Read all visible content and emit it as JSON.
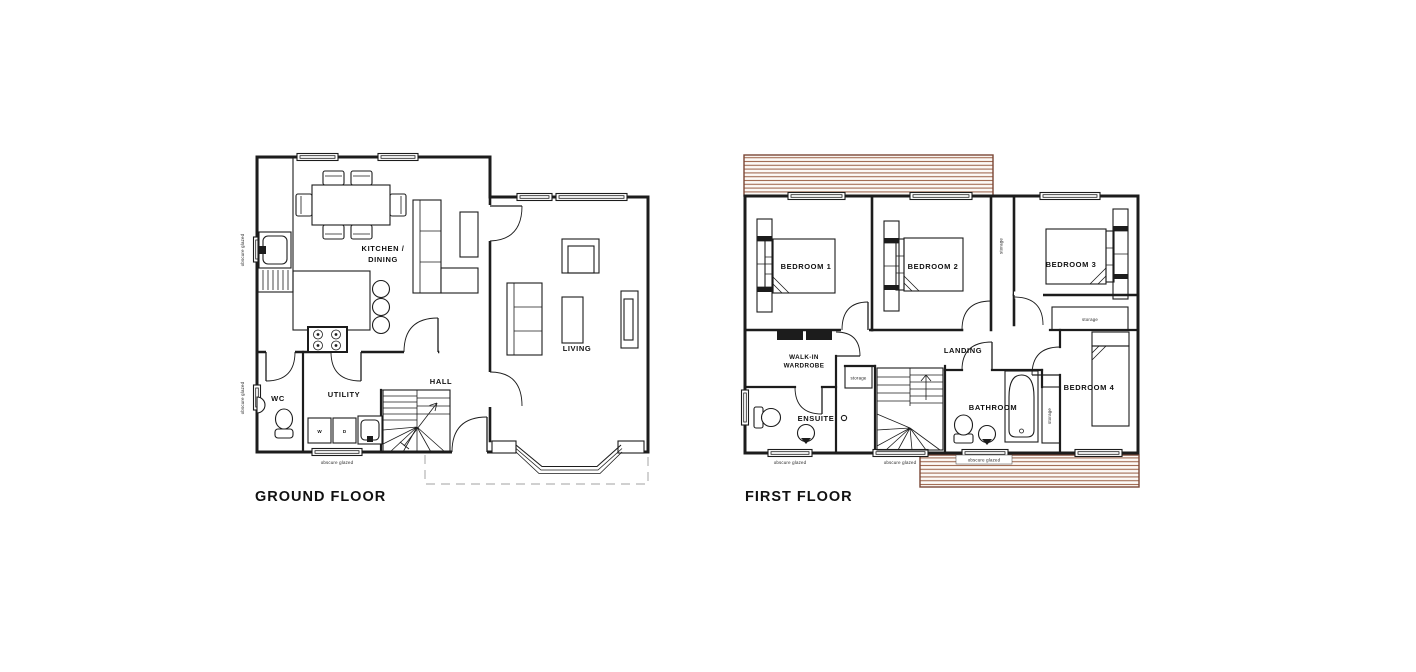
{
  "colors": {
    "wall": "#1c1c1c",
    "roof_hatch_line": "#a16a51",
    "roof_hatch_border": "#7b4736",
    "dashed_outline": "#b3b3b3"
  },
  "ground_floor": {
    "title": "GROUND FLOOR",
    "rooms": {
      "kitchen_dining_line1": "KITCHEN /",
      "kitchen_dining_line2": "DINING",
      "living": "LIVING",
      "hall": "HALL",
      "utility": "UTILITY",
      "wc": "WC"
    },
    "appliances": {
      "washer": "W",
      "dryer": "D"
    }
  },
  "first_floor": {
    "title": "FIRST FLOOR",
    "rooms": {
      "bedroom1": "BEDROOM 1",
      "bedroom2": "BEDROOM 2",
      "bedroom3": "BEDROOM 3",
      "bedroom4": "BEDROOM 4",
      "landing": "LANDING",
      "walk_in_line1": "WALK-IN",
      "walk_in_line2": "WARDROBE",
      "ensuite": "ENSUITE",
      "bathroom": "BATHROOM"
    }
  },
  "annotations": {
    "storage": "storage",
    "obscure_glazed": "obscure glazed"
  }
}
